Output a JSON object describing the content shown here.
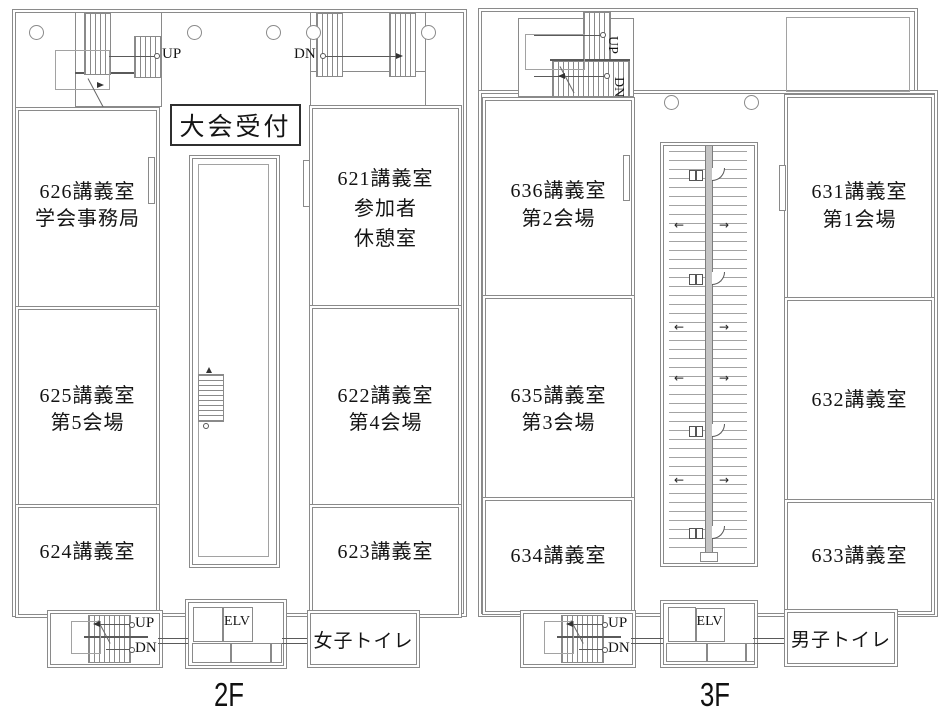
{
  "palette": {
    "background": "#ffffff",
    "wall": "#8a8a8a",
    "line": "#5a5a5a",
    "text": "#141414"
  },
  "floors": [
    {
      "caption": "2F",
      "reception": "大会受付",
      "top_stairs": {
        "up": "UP",
        "dn": "DN"
      },
      "bottom_stairs": {
        "up": "UP",
        "dn": "DN"
      },
      "elevator": "ELV",
      "toilet": "女子トイレ",
      "rooms": [
        {
          "number": "626",
          "lines": [
            "626講義室",
            "学会事務局"
          ]
        },
        {
          "number": "625",
          "lines": [
            "625講義室",
            "第5会場"
          ]
        },
        {
          "number": "624",
          "lines": [
            "624講義室"
          ]
        },
        {
          "number": "621",
          "lines": [
            "621講義室",
            "参加者",
            "休憩室"
          ]
        },
        {
          "number": "622",
          "lines": [
            "622講義室",
            "第4会場"
          ]
        },
        {
          "number": "623",
          "lines": [
            "623講義室"
          ]
        }
      ]
    },
    {
      "caption": "3F",
      "top_stairs": {
        "up": "UP",
        "dn": "DN"
      },
      "bottom_stairs": {
        "up": "UP",
        "dn": "DN"
      },
      "elevator": "ELV",
      "toilet": "男子トイレ",
      "rooms": [
        {
          "number": "636",
          "lines": [
            "636講義室",
            "第2会場"
          ]
        },
        {
          "number": "635",
          "lines": [
            "635講義室",
            "第3会場"
          ]
        },
        {
          "number": "634",
          "lines": [
            "634講義室"
          ]
        },
        {
          "number": "631",
          "lines": [
            "631講義室",
            "第1会場"
          ]
        },
        {
          "number": "632",
          "lines": [
            "632講義室"
          ]
        },
        {
          "number": "633",
          "lines": [
            "633講義室"
          ]
        }
      ]
    }
  ]
}
